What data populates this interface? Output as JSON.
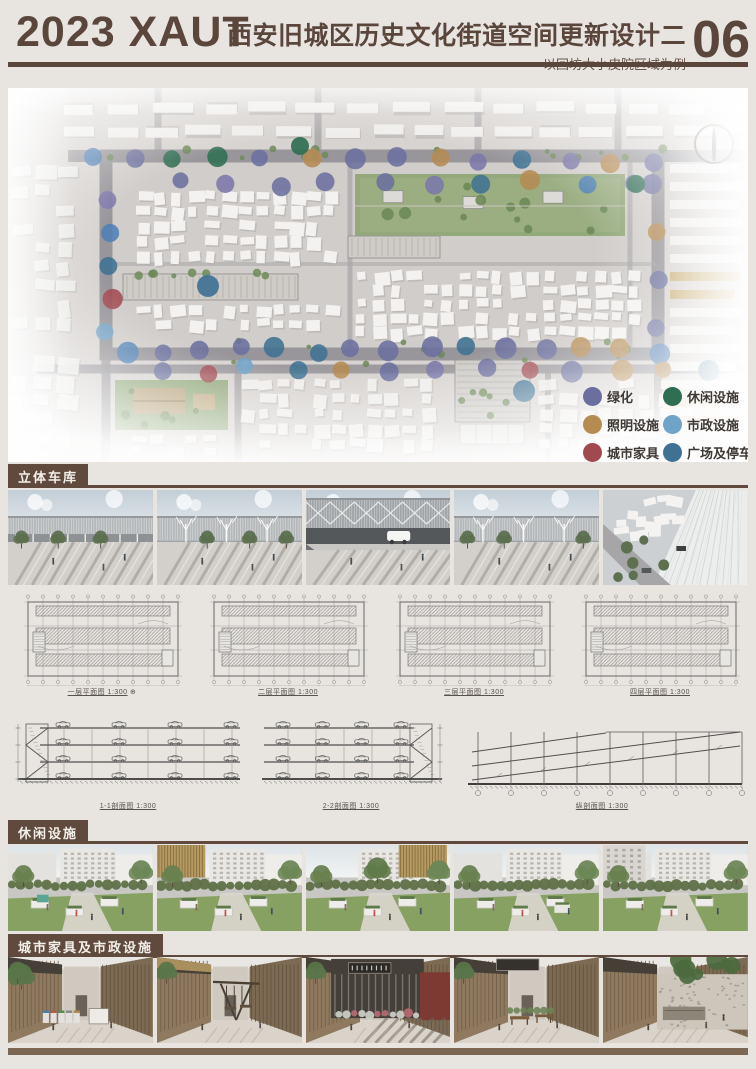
{
  "header": {
    "logo": "2023 XAUT",
    "title": "西安旧城区历史文化街道空间更新设计二",
    "subtitle": "——以回坊大小皮院区域为例",
    "page_number": "06"
  },
  "masterplan": {
    "north_icon": "north-arrow",
    "legend": [
      {
        "label": "绿化",
        "color": "#6b6f9e"
      },
      {
        "label": "照明设施",
        "color": "#b58b52"
      },
      {
        "label": "城市家具",
        "color": "#a04a50"
      },
      {
        "label": "休闲设施",
        "color": "#2f6e52"
      },
      {
        "label": "市政设施",
        "color": "#6fa3c8"
      },
      {
        "label": "广场及停车",
        "color": "#3f7292"
      }
    ]
  },
  "sections": [
    {
      "id": "garage",
      "title": "立体车库",
      "photo_count": 5
    },
    {
      "id": "leisure",
      "title": "休闲设施",
      "photo_count": 5
    },
    {
      "id": "furniture",
      "title": "城市家具及市政设施",
      "photo_count": 5
    }
  ],
  "drawings": {
    "plans": [
      {
        "caption": "一层平面图 1:300"
      },
      {
        "caption": "二层平面图 1:300"
      },
      {
        "caption": "三层平面图 1:300"
      },
      {
        "caption": "四层平面图 1:300"
      }
    ],
    "sections": [
      {
        "caption": "1-1剖面图 1:300"
      },
      {
        "caption": "2-2剖面图 1:300"
      },
      {
        "caption": "纵剖面图 1:300"
      }
    ]
  },
  "colors": {
    "accent": "#5b463b",
    "tab_bg": "#5f4a3d",
    "footer": "#7c6754",
    "page_bg": "#e8e4df"
  }
}
